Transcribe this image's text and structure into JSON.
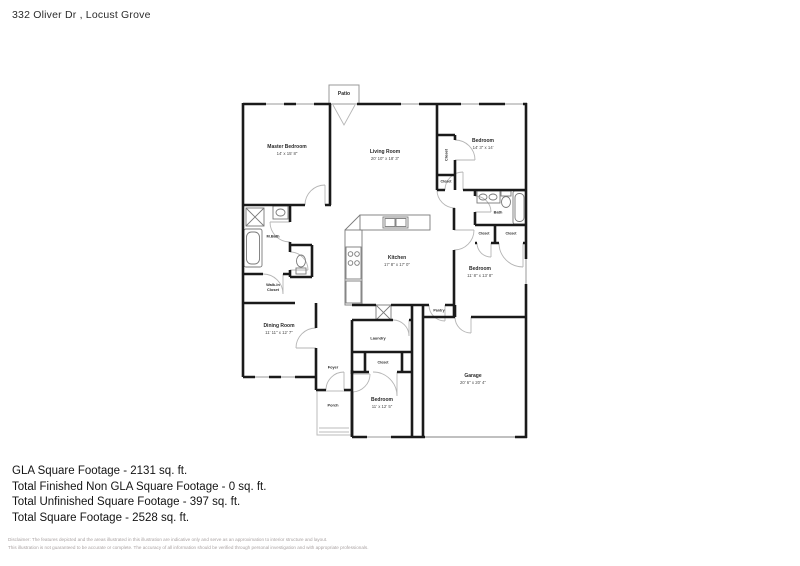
{
  "header": {
    "title": "332 Oliver Dr , Locust Grove"
  },
  "rooms": {
    "patio": {
      "name": "Patio"
    },
    "master_bedroom": {
      "name": "Master Bedroom",
      "dims": "14' x 15' 8\""
    },
    "living_room": {
      "name": "Living Room",
      "dims": "20' 10\" x 18' 3\""
    },
    "bedroom_top_right": {
      "name": "Bedroom",
      "dims": "14' 3\" x 14'"
    },
    "closet_tr": {
      "name": "Closet"
    },
    "closet_tr_small": {
      "name": "Closet"
    },
    "bath": {
      "name": "Bath"
    },
    "closet_r1": {
      "name": "Closet"
    },
    "closet_r2": {
      "name": "Closet"
    },
    "bedroom_right": {
      "name": "Bedroom",
      "dims": "11' 8\" x 13' 8\""
    },
    "m_bath": {
      "name": "M.Bath"
    },
    "walk_in_closet": {
      "name": "Walk-In Closet"
    },
    "kitchen": {
      "name": "Kitchen",
      "dims": "17' 8\" x 17' 0\""
    },
    "pantry": {
      "name": "Pantry"
    },
    "dining_room": {
      "name": "Dining Room",
      "dims": "11' 11\" x 12' 7\""
    },
    "foyer": {
      "name": "Foyer"
    },
    "porch": {
      "name": "Porch"
    },
    "laundry": {
      "name": "Laundry"
    },
    "closet_bottom": {
      "name": "Closet"
    },
    "bedroom_bottom": {
      "name": "Bedroom",
      "dims": "11' x 12' 5\""
    },
    "garage": {
      "name": "Garage",
      "dims": "20' 6\" x 20' 4\""
    }
  },
  "summary": {
    "lines": [
      "GLA Square Footage - 2131 sq. ft.",
      "Total Finished Non GLA Square Footage - 0 sq. ft.",
      "Total Unfinished Square Footage - 397 sq. ft.",
      "Total Square Footage - 2528 sq. ft."
    ]
  },
  "disclaimer": {
    "line1": "Disclaimer: The features depicted and the areas illustrated in this illustration are indicative only and serve as an approximation to interior structure and layout.",
    "line2": "This illustration is not guaranteed to be accurate or complete. The accuracy of all information should be verified through personal investigation and with appropriate professionals."
  },
  "colors": {
    "wall": "#1a1a1a",
    "door_arc": "#b5b5b5",
    "fixture": "#7a7a7a",
    "window": "#9a9a9a"
  }
}
